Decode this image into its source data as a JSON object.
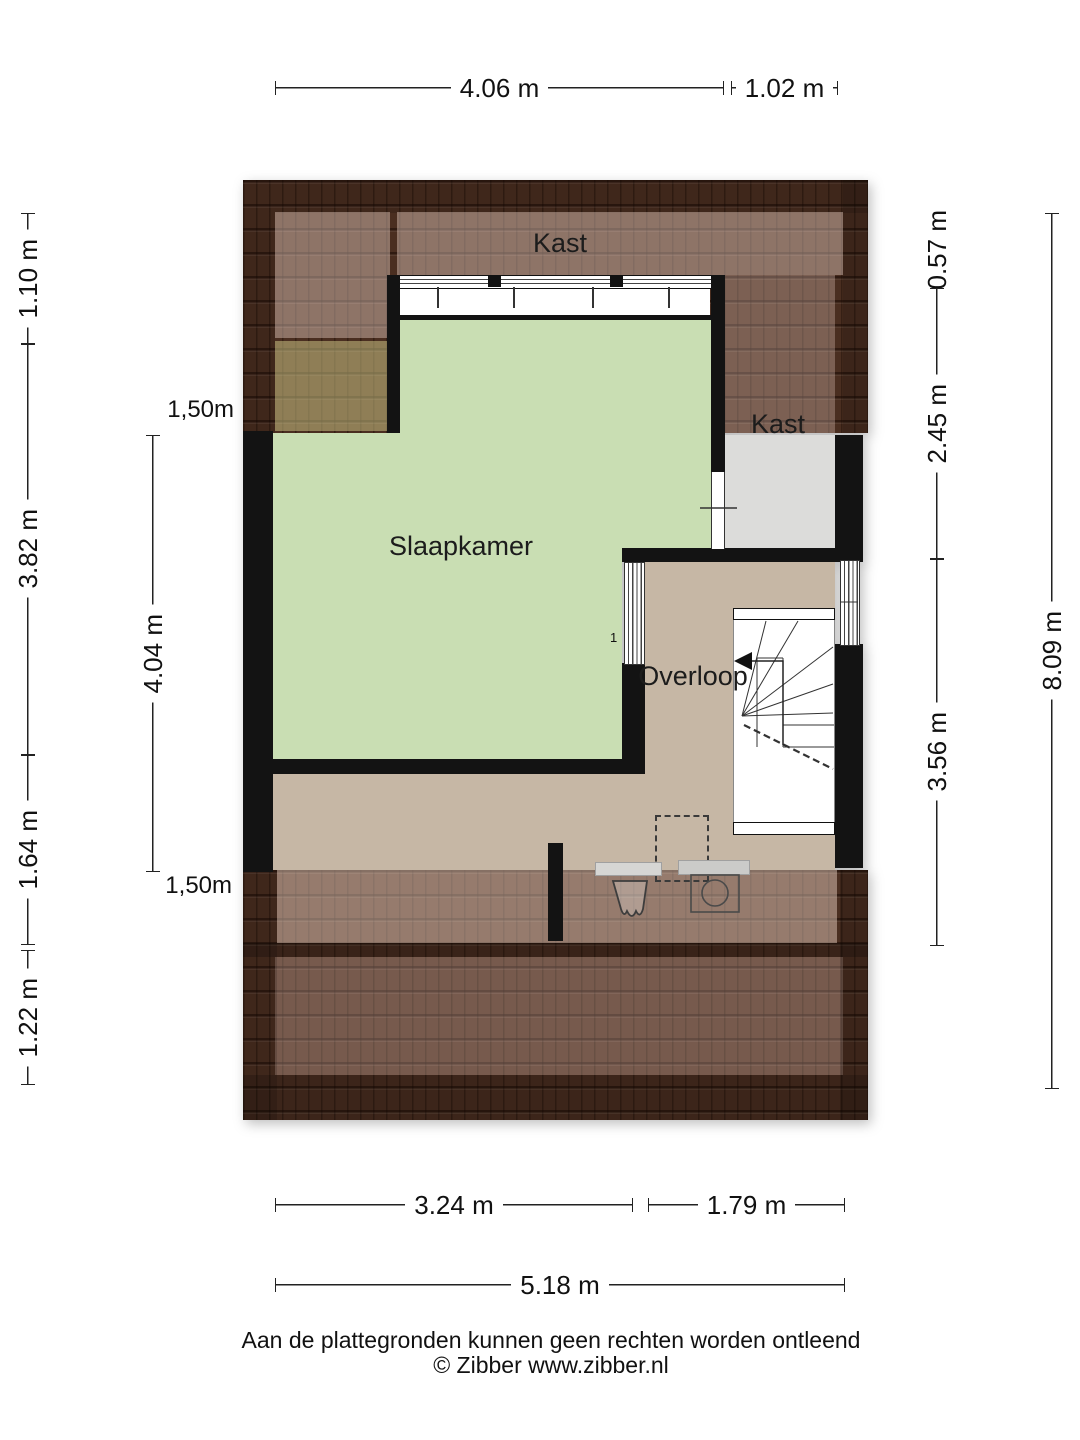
{
  "plan": {
    "rooms": {
      "slaapkamer": "Slaapkamer",
      "overloop": "Overloop",
      "kast_top": "Kast",
      "kast_right": "Kast"
    },
    "window_mark": "1",
    "icons": {
      "stairs_arrow": "stairs-direction-arrow",
      "washbasin": "washbasin-icon",
      "washing_machine": "washing-machine-icon"
    }
  },
  "dims": {
    "top_left_width": "4.06 m",
    "top_right_width": "1.02 m",
    "left_outer_1": "1.10 m",
    "left_outer_2": "3.82 m",
    "left_outer_3": "1.64 m",
    "left_outer_4": "1.22 m",
    "left_inner": "4.04 m",
    "knee_line_top": "1,50m",
    "knee_line_bottom": "1,50m",
    "right_inner_1": "0.57 m",
    "right_inner_2": "2.45 m",
    "right_inner_3": "3.56 m",
    "right_outer": "8.09 m",
    "bottom_left_width": "3.24 m",
    "bottom_right_width": "1.79 m",
    "bottom_total_width": "5.18 m"
  },
  "footer": {
    "disclaimer": "Aan de plattegronden kunnen geen rechten worden ontleend",
    "copyright": "© Zibber www.zibber.nl"
  },
  "colors": {
    "roof-dark": "#4a2e20",
    "floor-green": "#c9deb3",
    "floor-tan": "#c6b7a5",
    "floor-grey": "#dcdcda",
    "wall-black": "#131313"
  }
}
